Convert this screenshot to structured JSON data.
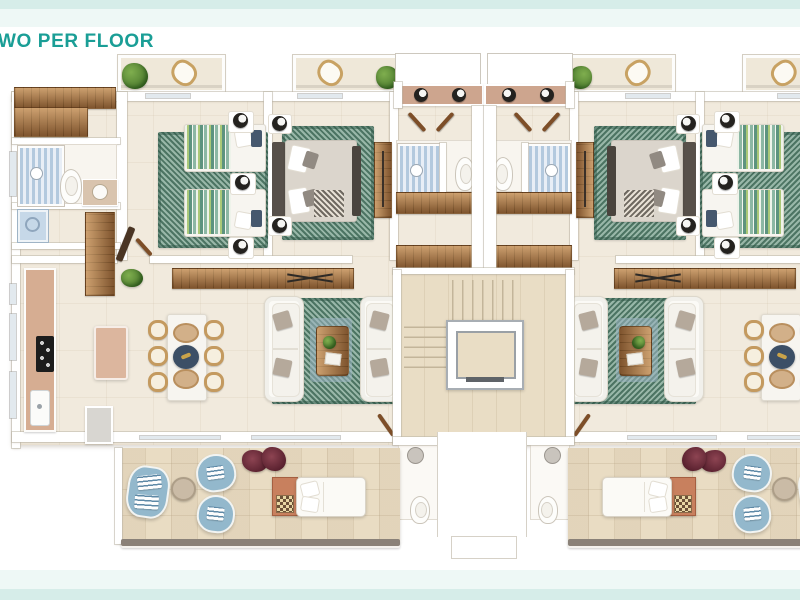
{
  "page": {
    "title": "WO PER FLOOR",
    "background": "#ffffff"
  },
  "theme": {
    "band_dark": "#d6ede9",
    "band_light": "#eef8f6",
    "title_color": "#1a9e96"
  },
  "floorplan": {
    "type": "architectural-floor-plan",
    "view": "top-down 3d render",
    "layout": "two mirrored apartments per floor around a central stair and elevator core",
    "palette": {
      "floor_cream": "#f1eadd",
      "terrace_beige": "#e9dcc3",
      "core_tan": "#e9ddc5",
      "walls": "#ffffff",
      "wood": "#9a6a3e",
      "rug_green": "#7ba390",
      "shower_tile_blue": "#b3c9de",
      "lounge_chair_blue": "#93b8cc",
      "side_table_terracotta": "#c8805e",
      "pillow_navy": "#46586e",
      "rattan_tan": "#c49a5f"
    },
    "apartment_rooms": [
      "balcony",
      "twin-bedroom",
      "master-bedroom",
      "family-bathroom",
      "laundry",
      "en-suite-shower-room",
      "hallway-closets",
      "kitchen",
      "dining-area",
      "living-room",
      "guest-wc",
      "terrace"
    ],
    "core_elements": [
      "staircase",
      "elevator",
      "entrance-lobby",
      "entry-step"
    ],
    "furniture_icons": [
      "twin-beds",
      "double-bed",
      "wardrobe",
      "sofa",
      "tv-console",
      "coffee-table",
      "dining-table",
      "dining-chair",
      "kitchen-island",
      "cooktop",
      "kitchen-sink",
      "washing-machine",
      "toilet",
      "shower",
      "vanity-sink",
      "lounge-chair",
      "love-seat",
      "daybed",
      "side-table",
      "round-table",
      "plant",
      "wall-lamp",
      "balcony-chair"
    ]
  }
}
